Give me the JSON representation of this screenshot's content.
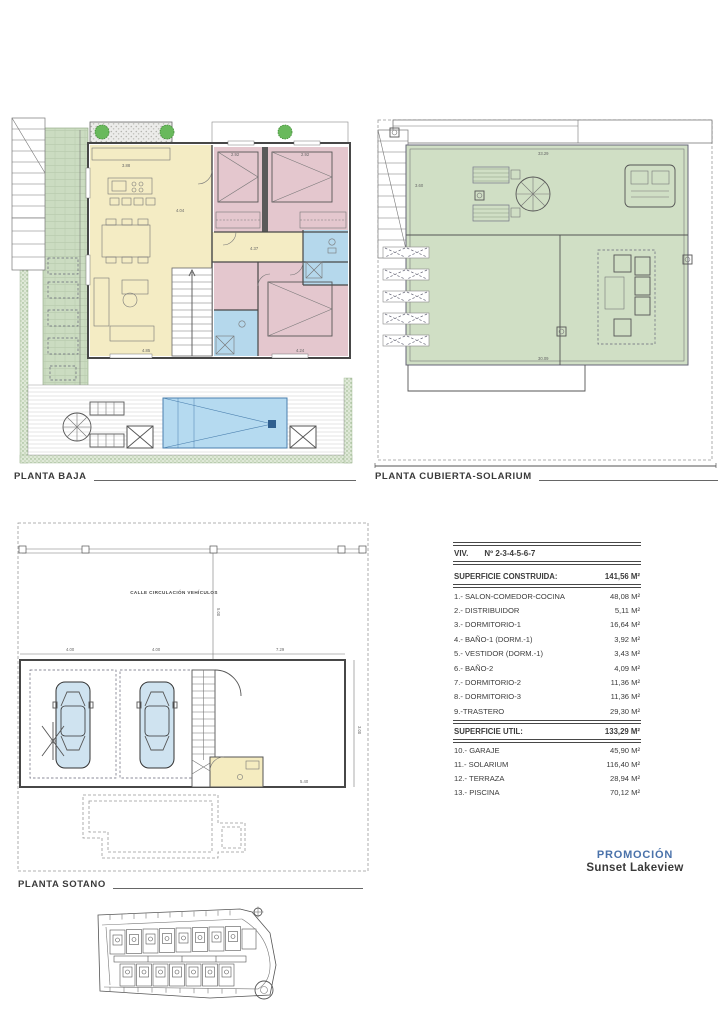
{
  "plans": {
    "baja": {
      "label": "PLANTA BAJA",
      "dims": [
        "3.88",
        "4.04",
        "4.37",
        "2.92",
        "2.92",
        "4.85",
        "4.24"
      ]
    },
    "solarium": {
      "label": "PLANTA CUBIERTA-SOLARIUM",
      "dims": [
        "33.29",
        "3.60",
        "5.40",
        "30.09"
      ]
    },
    "sotano": {
      "label": "PLANTA SOTANO",
      "street_label": "CALLE CIRCULACIÓN VEHÍCULOS",
      "dims": [
        "4.00",
        "4.00",
        "7.29",
        "5.00",
        "3.00",
        "5.40"
      ]
    }
  },
  "table": {
    "viv_label": "VIV.",
    "viv_number": "Nº 2-3-4-5-6-7",
    "constructed_label": "SUPERFICIE CONSTRUIDA:",
    "constructed_value": "141,56 M²",
    "rooms": [
      {
        "label": "1.- SALON-COMEDOR-COCINA",
        "value": "48,08 M²"
      },
      {
        "label": "2.- DISTRIBUIDOR",
        "value": "5,11 M²"
      },
      {
        "label": "3.- DORMITORIO-1",
        "value": "16,64 M²"
      },
      {
        "label": "4.- BAÑO-1 (DORM.-1)",
        "value": "3,92 M²"
      },
      {
        "label": "5.- VESTIDOR (DORM.-1)",
        "value": "3,43 M²"
      },
      {
        "label": "6.- BAÑO-2",
        "value": "4,09 M²"
      },
      {
        "label": "7.- DORMITORIO-2",
        "value": "11,36 M²"
      },
      {
        "label": "8.- DORMITORIO-3",
        "value": "11,36 M²"
      },
      {
        "label": "9.-TRASTERO",
        "value": "29,30 M²"
      }
    ],
    "util_label": "SUPERFICIE UTIL:",
    "util_value": "133,29 M²",
    "exterior": [
      {
        "label": "10.- GARAJE",
        "value": "45,90 M²"
      },
      {
        "label": "11.- SOLARIUM",
        "value": "116,40 M²"
      },
      {
        "label": "12.- TERRAZA",
        "value": "28,94 M²"
      },
      {
        "label": "13.- PISCINA",
        "value": "70,12 M²"
      }
    ]
  },
  "promo": {
    "title": "PROMOCIÓN",
    "name": "Sunset Lakeview"
  },
  "colors": {
    "accent_blue": "#4a72aa",
    "room_yellow": "#f4ecc4",
    "room_pink": "#e4c7ce",
    "bath_blue": "#b5d8ec",
    "garage_blue": "#b9dcf2",
    "solarium_green": "#d0dfc5",
    "garden_green": "#cbdcc1",
    "pool_blue": "#b5daf0",
    "tree_green": "#69b95c"
  }
}
